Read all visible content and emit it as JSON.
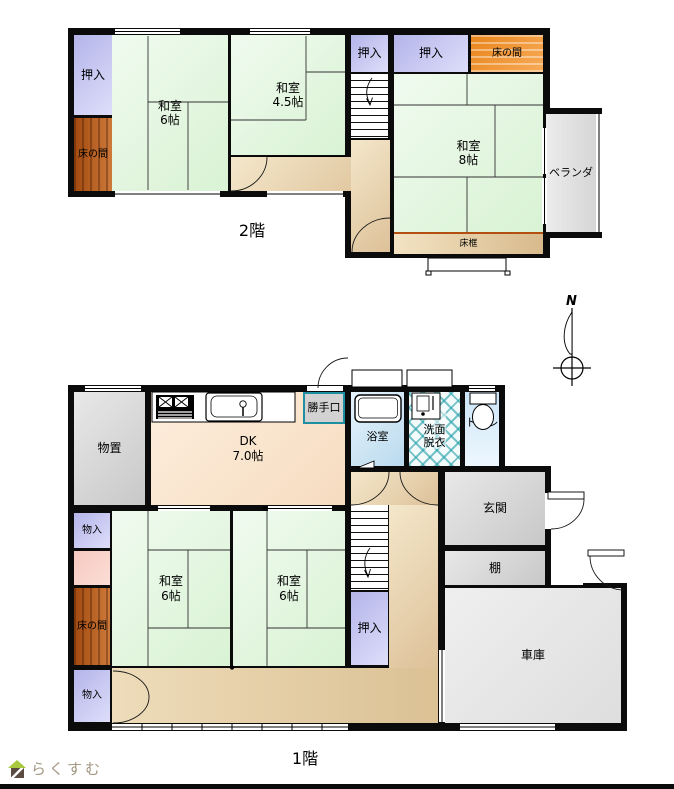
{
  "floor2": {
    "floor_label": "2階",
    "oshiire_left": "押入",
    "tokonoma_left": "床の間",
    "washitsu_6": "和室\n6帖",
    "washitsu_45": "和室\n4.5帖",
    "oshiire_mid": "押入",
    "oshiire_right": "押入",
    "tokonoma_right": "床の間",
    "washitsu_8": "和室\n8帖",
    "tokogamachi": "床框",
    "veranda": "ベランダ"
  },
  "floor1": {
    "floor_label": "1階",
    "monooki": "物置",
    "dk": "DK\n7.0帖",
    "katteguchi": "勝手口",
    "yokushitsu": "浴室",
    "senmen_datsui": "洗面\n脱衣",
    "toilet": "トイレ",
    "genkan": "玄関",
    "tana": "棚",
    "shako": "車庫",
    "mononyu_top": "物入",
    "tokonoma": "床の間",
    "mononyu_bottom": "物入",
    "washitsu_6_left": "和室\n6帖",
    "washitsu_6_right": "和室\n6帖",
    "oshiire": "押入"
  },
  "compass": {
    "north": "N"
  },
  "logo": {
    "text": "らくすむ"
  },
  "colors": {
    "tatami_green": "#ddf2d8",
    "closet_purple": "#c6c6f2",
    "tokonoma_brown": "#b05a1e",
    "tokonoma_orange": "#f29a3e",
    "corridor_tan": "#e9d5ae",
    "dk_peach": "#f9e3c8",
    "water_blue": "#cfe4f6",
    "washroom_teal": "#29a0aa",
    "room_gray": "#d6d6d6",
    "wall_black": "#0b0b0b"
  }
}
